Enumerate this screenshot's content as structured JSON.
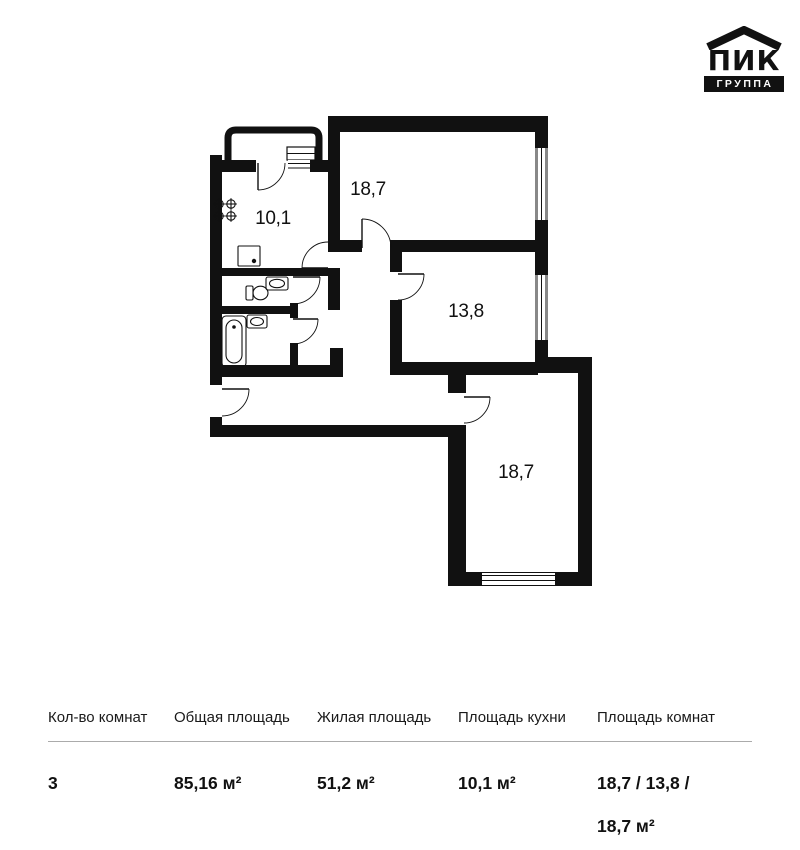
{
  "logo": {
    "brand": "ПИК",
    "subtitle": "ГРУППА"
  },
  "plan": {
    "rooms": [
      {
        "id": "kitchen",
        "label": "10,1"
      },
      {
        "id": "room-top",
        "label": "18,7"
      },
      {
        "id": "room-middle",
        "label": "13,8"
      },
      {
        "id": "room-bottom",
        "label": "18,7"
      }
    ]
  },
  "table": {
    "columns": [
      "Кол-во комнат",
      "Общая площадь",
      "Жилая площадь",
      "Площадь кухни",
      "Площадь комнат"
    ],
    "row": {
      "rooms_count": "3",
      "total_area": "85,16 м²",
      "living_area": "51,2 м²",
      "kitchen_area": "10,1 м²",
      "rooms_areas": "18,7 / 13,8 / 18,7 м²"
    }
  }
}
